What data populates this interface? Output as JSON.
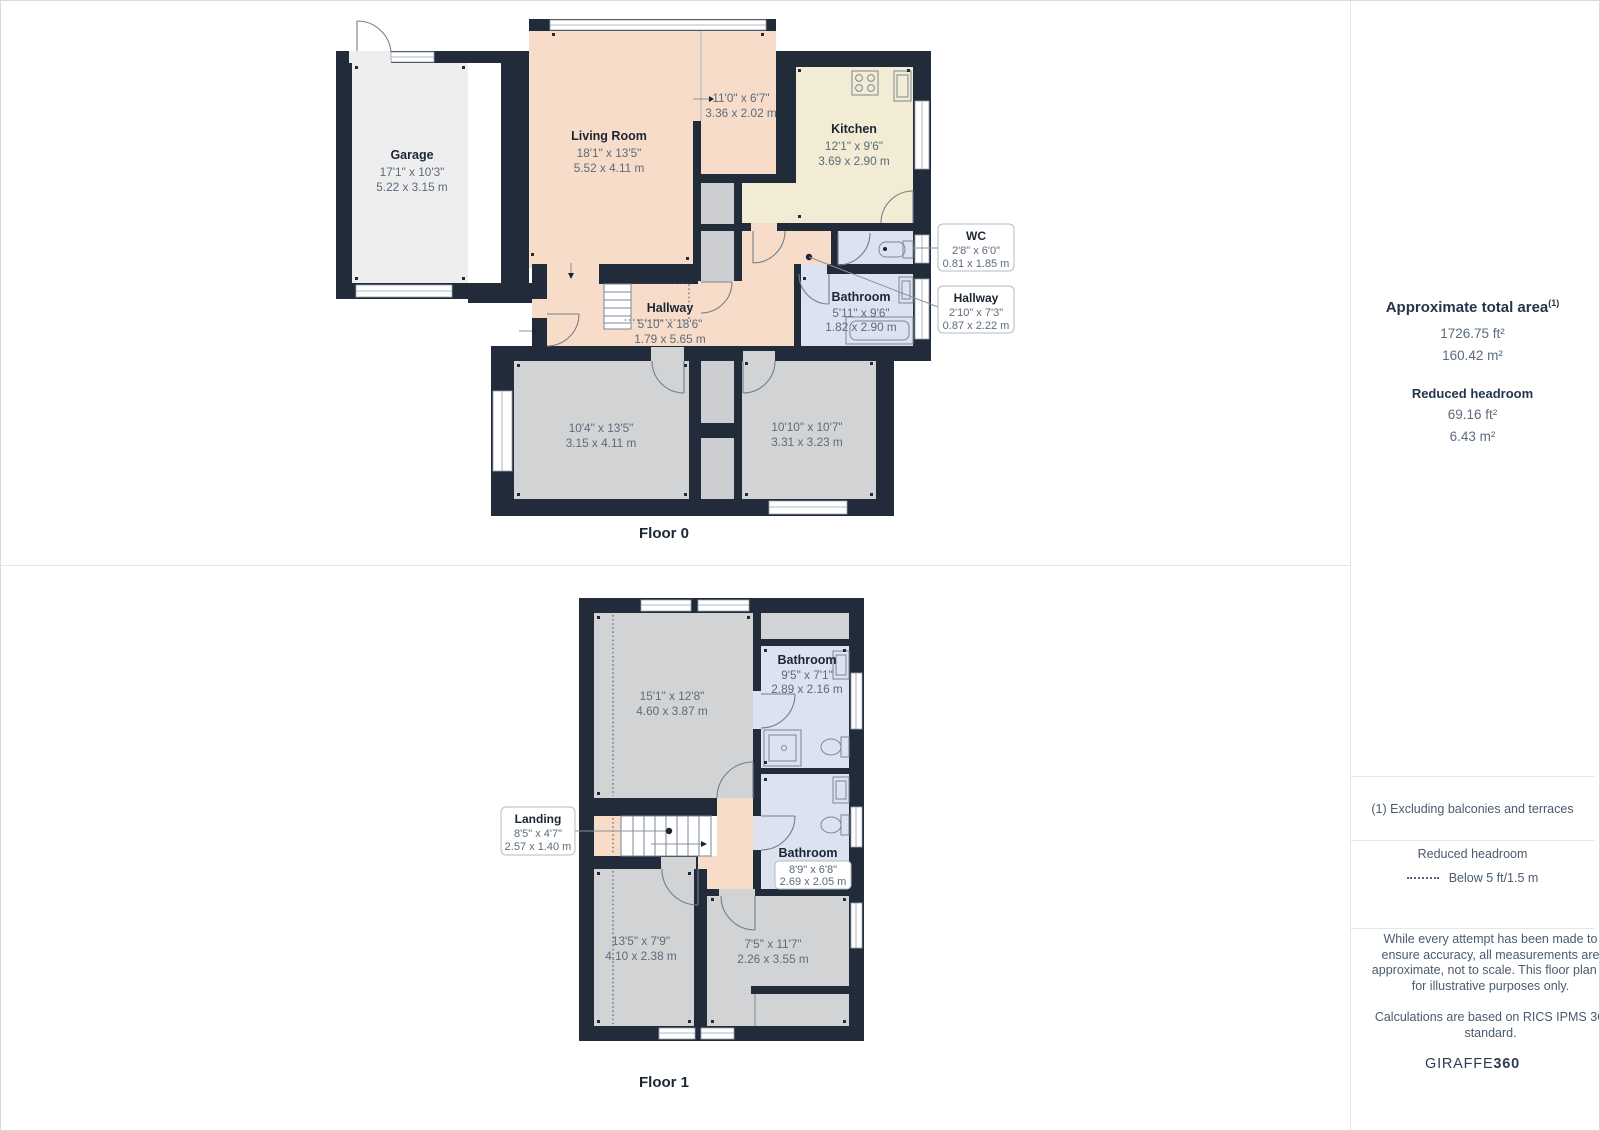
{
  "floor0": {
    "label": "Floor 0",
    "rooms": {
      "garage": {
        "name": "Garage",
        "dims_ft": "17'1\" x 10'3\"",
        "dims_m": "5.22 x 3.15 m"
      },
      "living": {
        "name": "Living Room",
        "dims_ft": "18'1\" x 13'5\"",
        "dims_m": "5.52 x 4.11 m"
      },
      "living_sub": {
        "dims_ft": "11'0\" x 6'7\"",
        "dims_m": "3.36 x 2.02 m"
      },
      "kitchen": {
        "name": "Kitchen",
        "dims_ft": "12'1\" x 9'6\"",
        "dims_m": "3.69 x 2.90 m"
      },
      "bathroom": {
        "name": "Bathroom",
        "dims_ft": "5'11\" x 9'6\"",
        "dims_m": "1.82 x 2.90 m"
      },
      "hallway": {
        "name": "Hallway",
        "dims_ft": "5'10\" x 18'6\"",
        "dims_m": "1.79 x 5.65 m"
      },
      "bedroom1": {
        "dims_ft": "10'4\" x 13'5\"",
        "dims_m": "3.15 x 4.11 m"
      },
      "bedroom2": {
        "dims_ft": "10'10\" x 10'7\"",
        "dims_m": "3.31 x 3.23 m"
      }
    },
    "callouts": {
      "wc": {
        "name": "WC",
        "dims_ft": "2'8\" x 6'0\"",
        "dims_m": "0.81 x 1.85 m"
      },
      "hallway": {
        "name": "Hallway",
        "dims_ft": "2'10\" x 7'3\"",
        "dims_m": "0.87 x 2.22 m"
      }
    }
  },
  "floor1": {
    "label": "Floor 1",
    "rooms": {
      "bedroom_large": {
        "dims_ft": "15'1\" x 12'8\"",
        "dims_m": "4.60 x 3.87 m"
      },
      "bathroom_top": {
        "name": "Bathroom",
        "dims_ft": "9'5\" x 7'1\"",
        "dims_m": "2.89 x 2.16 m"
      },
      "bathroom_mid": {
        "name": "Bathroom",
        "dims_ft": "8'9\" x 6'8\"",
        "dims_m": "2.69 x 2.05 m"
      },
      "bedroom_bl": {
        "dims_ft": "13'5\" x 7'9\"",
        "dims_m": "4.10 x 2.38 m"
      },
      "bedroom_br": {
        "dims_ft": "7'5\" x 11'7\"",
        "dims_m": "2.26 x 3.55 m"
      }
    },
    "callouts": {
      "landing": {
        "name": "Landing",
        "dims_ft": "8'5\" x 4'7\"",
        "dims_m": "2.57 x 1.40 m"
      }
    }
  },
  "sidebar": {
    "area": {
      "title": "Approximate total area",
      "sup": "(1)",
      "ft": "1726.75 ft²",
      "m": "160.42 m²"
    },
    "reduced": {
      "title": "Reduced headroom",
      "ft": "69.16 ft²",
      "m": "6.43 m²"
    },
    "note": "(1) Excluding balconies and terraces",
    "legend": {
      "title": "Reduced headroom",
      "item": "Below 5 ft/1.5 m"
    },
    "disclaimer": {
      "p1": "While every attempt has been made to ensure accuracy, all measurements are approximate, not to scale. This floor plan is for illustrative purposes only.",
      "p2": "Calculations are based on RICS IPMS 3C standard."
    },
    "logo": {
      "name": "GIRAFFE",
      "number": "360"
    }
  },
  "colors": {
    "wall": "#212b3a",
    "living_peach": "#f6dcc9",
    "kitchen_cream": "#f2ecd4",
    "bathroom_blue": "#dce2ef",
    "room_gray": "#d2d3d5",
    "garage_gray": "#eeeeef"
  }
}
